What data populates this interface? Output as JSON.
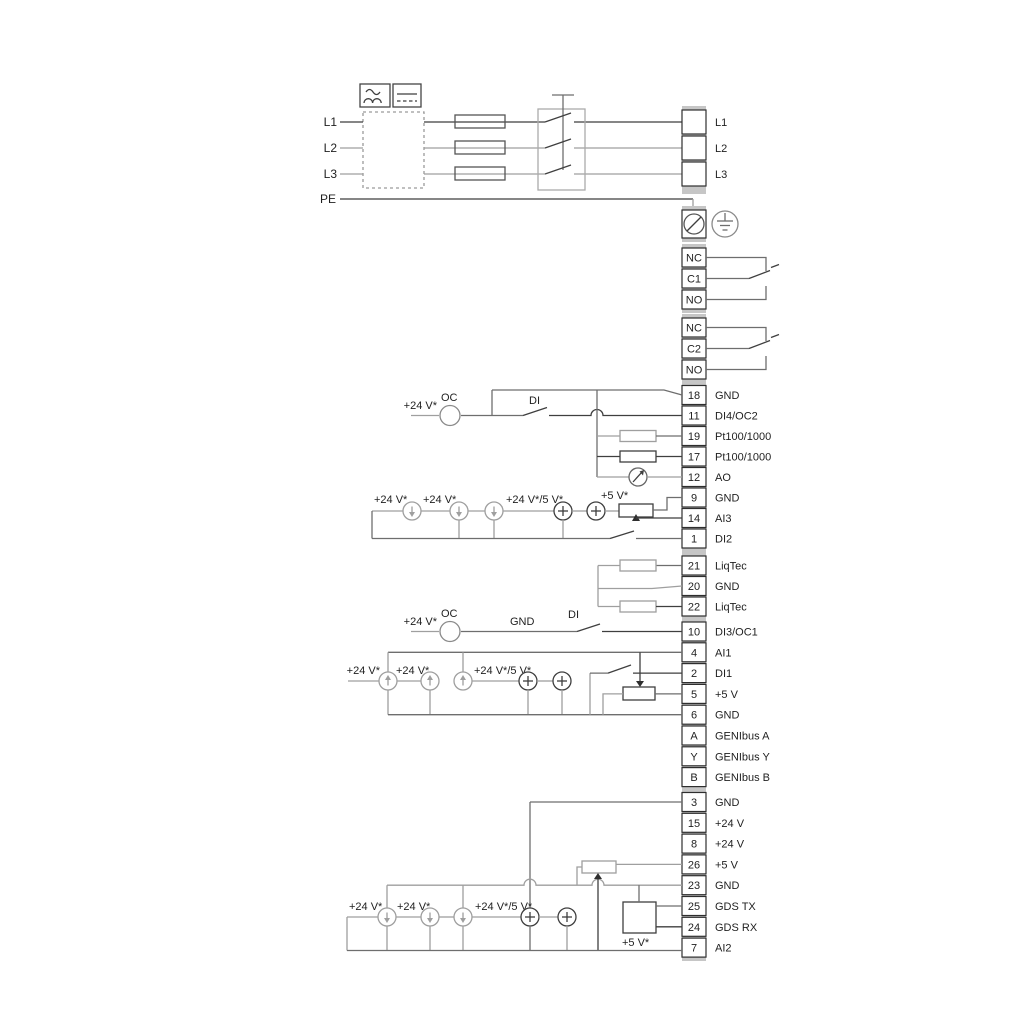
{
  "labels": {
    "v24": "+24 V*",
    "v24_5": "+24 V*/5 V*",
    "v5": "+5 V*",
    "oc": "OC",
    "di": "DI",
    "gnd": "GND"
  },
  "power": {
    "inputs": [
      "L1",
      "L2",
      "L3",
      "PE"
    ],
    "outputs": [
      "L1",
      "L2",
      "L3"
    ]
  },
  "relay1": [
    "NC",
    "C1",
    "NO"
  ],
  "relay2": [
    "NC",
    "C2",
    "NO"
  ],
  "strip1": [
    {
      "num": "18",
      "label": "GND"
    },
    {
      "num": "11",
      "label": "DI4/OC2"
    },
    {
      "num": "19",
      "label": "Pt100/1000"
    },
    {
      "num": "17",
      "label": "Pt100/1000"
    },
    {
      "num": "12",
      "label": "AO"
    },
    {
      "num": "9",
      "label": "GND"
    },
    {
      "num": "14",
      "label": "AI3"
    },
    {
      "num": "1",
      "label": "DI2"
    }
  ],
  "liqtec": [
    {
      "num": "21",
      "label": "LiqTec"
    },
    {
      "num": "20",
      "label": "GND"
    },
    {
      "num": "22",
      "label": "LiqTec"
    }
  ],
  "strip2": [
    {
      "num": "10",
      "label": "DI3/OC1"
    },
    {
      "num": "4",
      "label": "AI1"
    },
    {
      "num": "2",
      "label": "DI1"
    },
    {
      "num": "5",
      "label": "+5 V"
    },
    {
      "num": "6",
      "label": "GND"
    },
    {
      "num": "A",
      "label": "GENIbus A"
    },
    {
      "num": "Y",
      "label": "GENIbus Y"
    },
    {
      "num": "B",
      "label": "GENIbus B"
    }
  ],
  "strip3": [
    {
      "num": "3",
      "label": "GND"
    },
    {
      "num": "15",
      "label": "+24 V"
    },
    {
      "num": "8",
      "label": "+24 V"
    },
    {
      "num": "26",
      "label": "+5 V"
    },
    {
      "num": "23",
      "label": "GND"
    },
    {
      "num": "25",
      "label": "GDS TX"
    },
    {
      "num": "24",
      "label": "GDS RX"
    },
    {
      "num": "7",
      "label": "AI2"
    }
  ],
  "colors": {
    "wire_dark": "#3f3f3f",
    "wire_grey": "#9f9f9f",
    "strip_bg": "#c6c6c6"
  }
}
